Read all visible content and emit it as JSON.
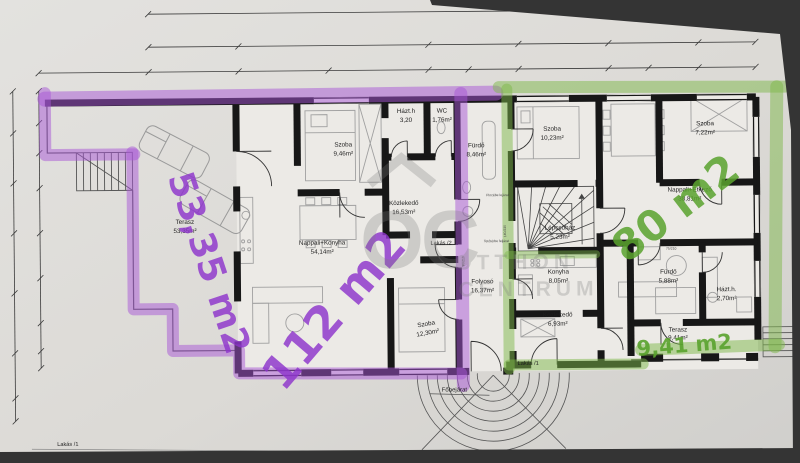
{
  "photo": {
    "background": "#383838",
    "paper": "#dcdad6",
    "wall_color": "#171717",
    "purple_marker": "#a855d6",
    "green_marker": "#7db84a"
  },
  "watermark": {
    "monogram": "OC",
    "word1": "OTTHON",
    "word2": "CENTRUM"
  },
  "dimensions": {
    "overall_width": "1000.5"
  },
  "apartments": [
    {
      "id": "lakas2",
      "label": "Lakás /2",
      "marked_total": "112 m2",
      "marker_color": "#9b3fd1"
    },
    {
      "id": "lakas1",
      "label": "Lakás /1",
      "marked_total": "80 m2",
      "marker_color": "#66b13b"
    }
  ],
  "rooms": [
    {
      "name": "Terasz",
      "area": "53,35m²"
    },
    {
      "name": "Szoba",
      "area": "9,46m²"
    },
    {
      "name": "Házt.h",
      "area": "3,20"
    },
    {
      "name": "WC",
      "area": "1,76m²"
    },
    {
      "name": "Fürdő",
      "area": "8,46m²"
    },
    {
      "name": "Közlekedő",
      "area": "16,53m²"
    },
    {
      "name": "Nappali+Konyha",
      "area": "54,14m²"
    },
    {
      "name": "Szoba",
      "area": "12,30m²"
    },
    {
      "name": "Folyosó",
      "area": "16,37m²"
    },
    {
      "name": "Szoba",
      "area": "10,23m²"
    },
    {
      "name": "Lépcsőház",
      "area": "5,23m²"
    },
    {
      "name": "Konyha",
      "area": "8,05m²"
    },
    {
      "name": "Közlekedő",
      "area": "6,93m²"
    },
    {
      "name": "Szoba",
      "area": "7,22m²"
    },
    {
      "name": "Nappali+Étkező",
      "area": "38,81m²"
    },
    {
      "name": "Fürdő",
      "area": "5,88m²"
    },
    {
      "name": "Házt.h.",
      "area": "2,70m²"
    },
    {
      "name": "Terasz",
      "area": "9,41m²"
    }
  ],
  "handwritten": {
    "terasz_left": "53,35 m2",
    "lakas2_total": "112 m2",
    "lakas1_total": "80 m2",
    "terasz_right": "9,41 m2"
  },
  "labels": {
    "lakas1": "Lakás /1",
    "lakas2": "Lakás /2",
    "fobejarat": "Főbejárat",
    "stair_note_basement": "Pincébe lejárat",
    "stair_note_attic": "Tetőtérbe feljárat"
  },
  "door_tags": [
    "140/230",
    "90/210",
    "75/210"
  ]
}
